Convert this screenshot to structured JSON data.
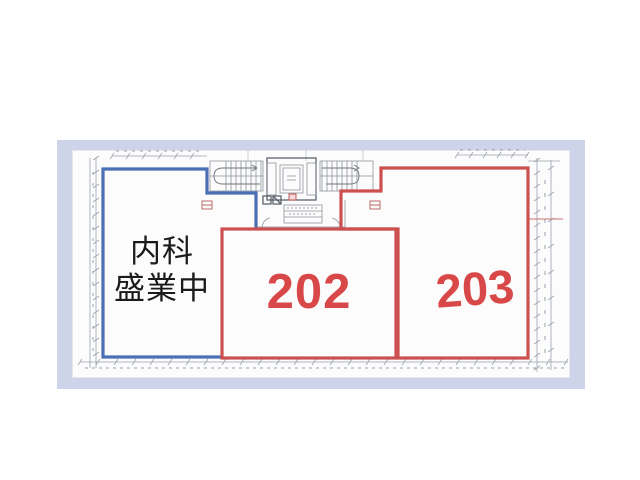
{
  "plan": {
    "unit_left": {
      "label_line1": "内科",
      "label_line2": "盛業中"
    },
    "unit_202": {
      "label": "202"
    },
    "unit_203": {
      "label": "203"
    }
  },
  "colors": {
    "mat": "#cdd3e8",
    "paper": "#fcfcfc",
    "unit_left_outline": "#4a6fb5",
    "unit_outline_red": "#cd5050",
    "label_red": "#d94848",
    "label_black": "#1b1b1b",
    "drawing_line": "#9aa2ad",
    "wall_dark": "#5d636d"
  }
}
